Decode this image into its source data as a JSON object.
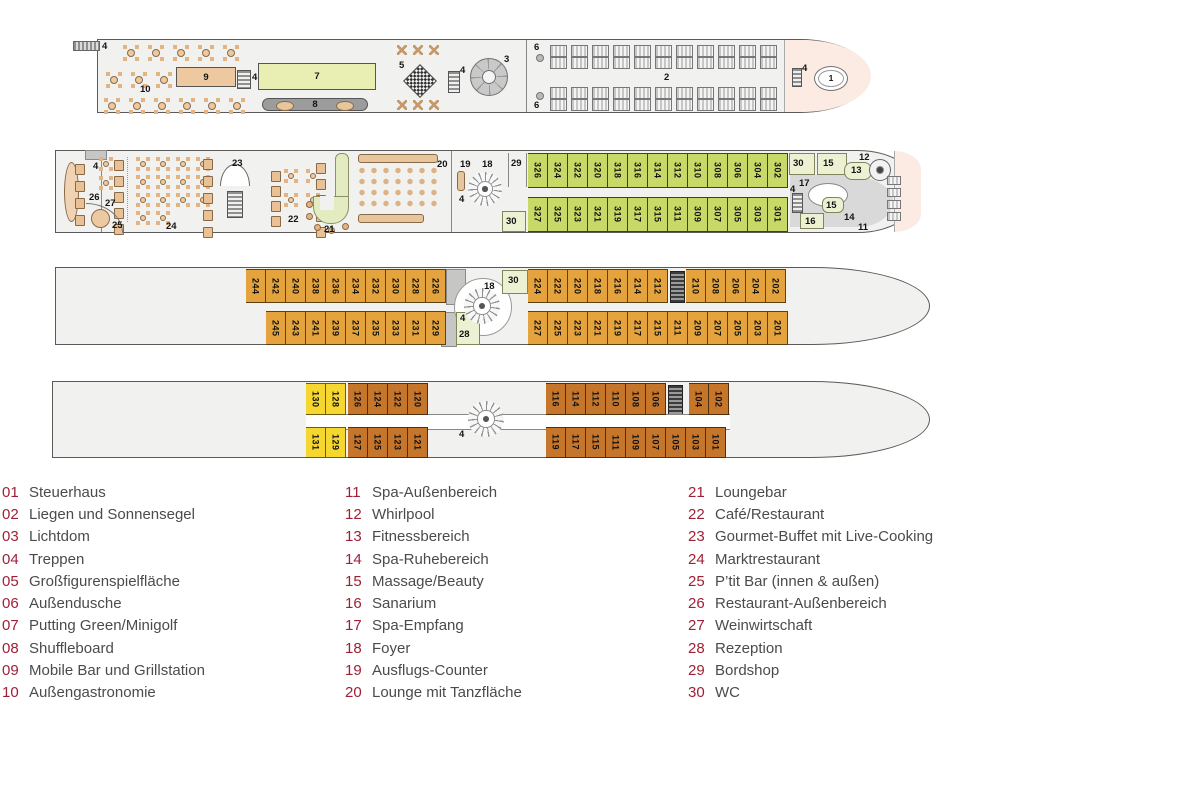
{
  "legend": {
    "columns": [
      {
        "items": [
          {
            "n": "01",
            "label": "Steuerhaus"
          },
          {
            "n": "02",
            "label": "Liegen und Sonnensegel"
          },
          {
            "n": "03",
            "label": "Lichtdom"
          },
          {
            "n": "04",
            "label": "Treppen"
          },
          {
            "n": "05",
            "label": "Großfigurenspielfläche"
          },
          {
            "n": "06",
            "label": "Außendusche"
          },
          {
            "n": "07",
            "label": "Putting Green/Minigolf"
          },
          {
            "n": "08",
            "label": "Shuffleboard"
          },
          {
            "n": "09",
            "label": "Mobile Bar und Grillstation"
          },
          {
            "n": "10",
            "label": "Außengastronomie"
          }
        ]
      },
      {
        "items": [
          {
            "n": "11",
            "label": "Spa-Außenbereich"
          },
          {
            "n": "12",
            "label": "Whirlpool"
          },
          {
            "n": "13",
            "label": "Fitnessbereich"
          },
          {
            "n": "14",
            "label": "Spa-Ruhebereich"
          },
          {
            "n": "15",
            "label": "Massage/Beauty"
          },
          {
            "n": "16",
            "label": "Sanarium"
          },
          {
            "n": "17",
            "label": "Spa-Empfang"
          },
          {
            "n": "18",
            "label": "Foyer"
          },
          {
            "n": "19",
            "label": "Ausflugs-Counter"
          },
          {
            "n": "20",
            "label": "Lounge mit Tanzfläche"
          }
        ]
      },
      {
        "items": [
          {
            "n": "21",
            "label": "Loungebar"
          },
          {
            "n": "22",
            "label": "Café/Restaurant"
          },
          {
            "n": "23",
            "label": "Gourmet-Buffet mit Live-Cooking"
          },
          {
            "n": "24",
            "label": "Marktrestaurant"
          },
          {
            "n": "25",
            "label": "P’tit Bar (innen & außen)"
          },
          {
            "n": "26",
            "label": "Restaurant-Außenbereich"
          },
          {
            "n": "27",
            "label": "Weinwirtschaft"
          },
          {
            "n": "28",
            "label": "Rezeption"
          },
          {
            "n": "29",
            "label": "Bordshop"
          },
          {
            "n": "30",
            "label": "WC"
          }
        ]
      }
    ]
  },
  "decks": {
    "deck1": {
      "labels": {
        "k4a": "4",
        "k10": "10",
        "k9": "9",
        "k4b": "4",
        "k7": "7",
        "k8": "8",
        "k5": "5",
        "k4c": "4",
        "k3": "3",
        "k6a": "6",
        "k6b": "6",
        "k2": "2",
        "k4d": "4",
        "k1": "1"
      }
    },
    "deck2": {
      "labels": {
        "k4a": "4",
        "k26": "26",
        "k27": "27",
        "k25": "25",
        "k24": "24",
        "k23": "23",
        "k22": "22",
        "k21": "21",
        "k20": "20",
        "k19": "19",
        "k18": "18",
        "k4b": "4",
        "k29": "29",
        "k30a": "30",
        "k30b": "30",
        "k15a": "15",
        "k17": "17",
        "k13": "13",
        "k12": "12",
        "k15b": "15",
        "k4c": "4",
        "k16": "16",
        "k14": "14",
        "k11": "11"
      },
      "cabins_top": [
        "326",
        "324",
        "322",
        "320",
        "318",
        "316",
        "314",
        "312",
        "310",
        "308",
        "306",
        "304",
        "302"
      ],
      "cabins_bottom": [
        "327",
        "325",
        "323",
        "321",
        "319",
        "317",
        "315",
        "311",
        "309",
        "307",
        "305",
        "303",
        "301"
      ]
    },
    "deck3": {
      "labels": {
        "k18": "18",
        "k4": "4",
        "k30": "30",
        "k28": "28"
      },
      "cabins_top1": [
        "244",
        "242",
        "240",
        "238",
        "236",
        "234",
        "232",
        "230",
        "228",
        "226"
      ],
      "cabins_top2": [
        "224",
        "222",
        "220",
        "218",
        "216",
        "214",
        "212"
      ],
      "cabins_top3": [
        "210",
        "208",
        "206",
        "204",
        "202"
      ],
      "cabins_bottom1": [
        "245",
        "243",
        "241",
        "239",
        "237",
        "235",
        "233",
        "231",
        "229"
      ],
      "cabins_bottom2": [
        "227",
        "225",
        "223",
        "221",
        "219",
        "217",
        "215",
        "211",
        "209",
        "207",
        "205",
        "203",
        "201"
      ]
    },
    "deck4": {
      "labels": {
        "k4": "4"
      },
      "cabins_top_yellow": [
        "130",
        "128"
      ],
      "cabins_top_brown1": [
        "126",
        "124",
        "122",
        "120"
      ],
      "cabins_top_brown2": [
        "116",
        "114",
        "112",
        "110",
        "108",
        "106"
      ],
      "cabins_top_brown3": [
        "104",
        "102"
      ],
      "cabins_bottom_yellow": [
        "131",
        "129"
      ],
      "cabins_bottom_brown1": [
        "127",
        "125",
        "123",
        "121"
      ],
      "cabins_bottom_brown2": [
        "119",
        "117",
        "115",
        "111",
        "109",
        "107",
        "105",
        "103",
        "101"
      ]
    }
  },
  "colors": {
    "legend_number": "#9e2036",
    "legend_text": "#4b4b4d",
    "deck_fill": "#f1f1ef",
    "cabin_green": "#c9d967",
    "cabin_orange": "#e4a33c",
    "cabin_brown": "#c5762b",
    "cabin_yellow": "#f6d72f",
    "pale_green_room": "#ebf1d2",
    "bow_pink": "#fcebe2",
    "furniture_tan": "#ecc9a0"
  }
}
